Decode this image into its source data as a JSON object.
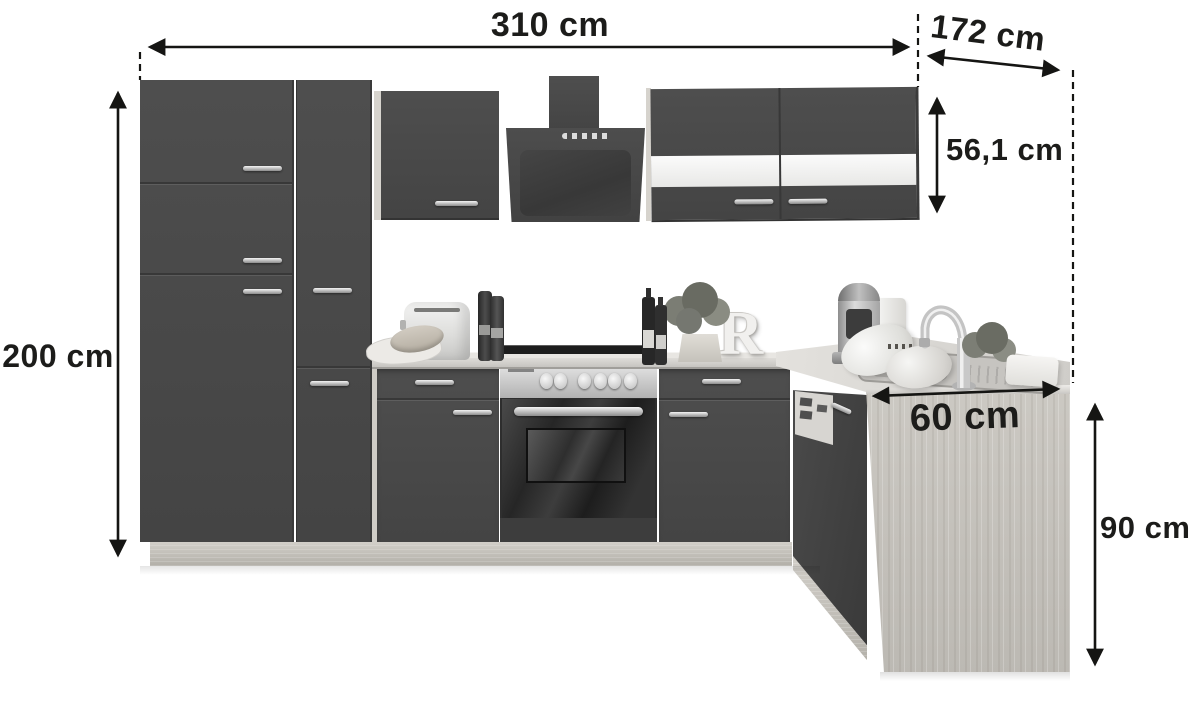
{
  "product": {
    "decor_letter": "R"
  },
  "dimensions": {
    "total_width": "310 cm",
    "side_depth": "172 cm",
    "wall_cabinet_height": "56,1 cm",
    "total_height": "200 cm",
    "worktop_depth": "60 cm",
    "worktop_height": "90 cm"
  },
  "colors": {
    "cabinet_front": "#4a4a4a",
    "accent_stripe": "#f4f4f4",
    "oak_decor": "#c8c5bf",
    "annotation": "#1c1c1a",
    "background": "#ffffff"
  }
}
